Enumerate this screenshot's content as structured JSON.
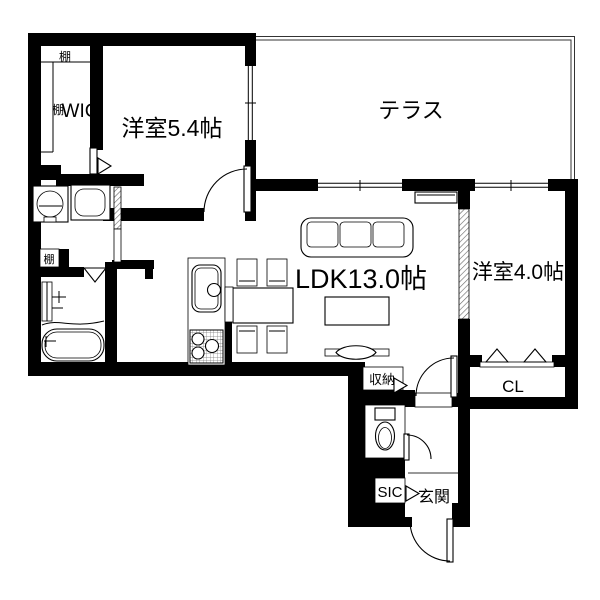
{
  "floor_plan": {
    "background": "#ffffff",
    "wall_color": "#000000",
    "labels": {
      "terrace": "テラス",
      "western_room_large": "洋室5.4帖",
      "ldk": "LDK13.0帖",
      "western_room_small": "洋室4.0帖",
      "wic": "WIC",
      "closet": "CL",
      "storage": "収納",
      "shoe_closet": "SIC",
      "entrance": "玄関",
      "shelf": "棚"
    }
  }
}
